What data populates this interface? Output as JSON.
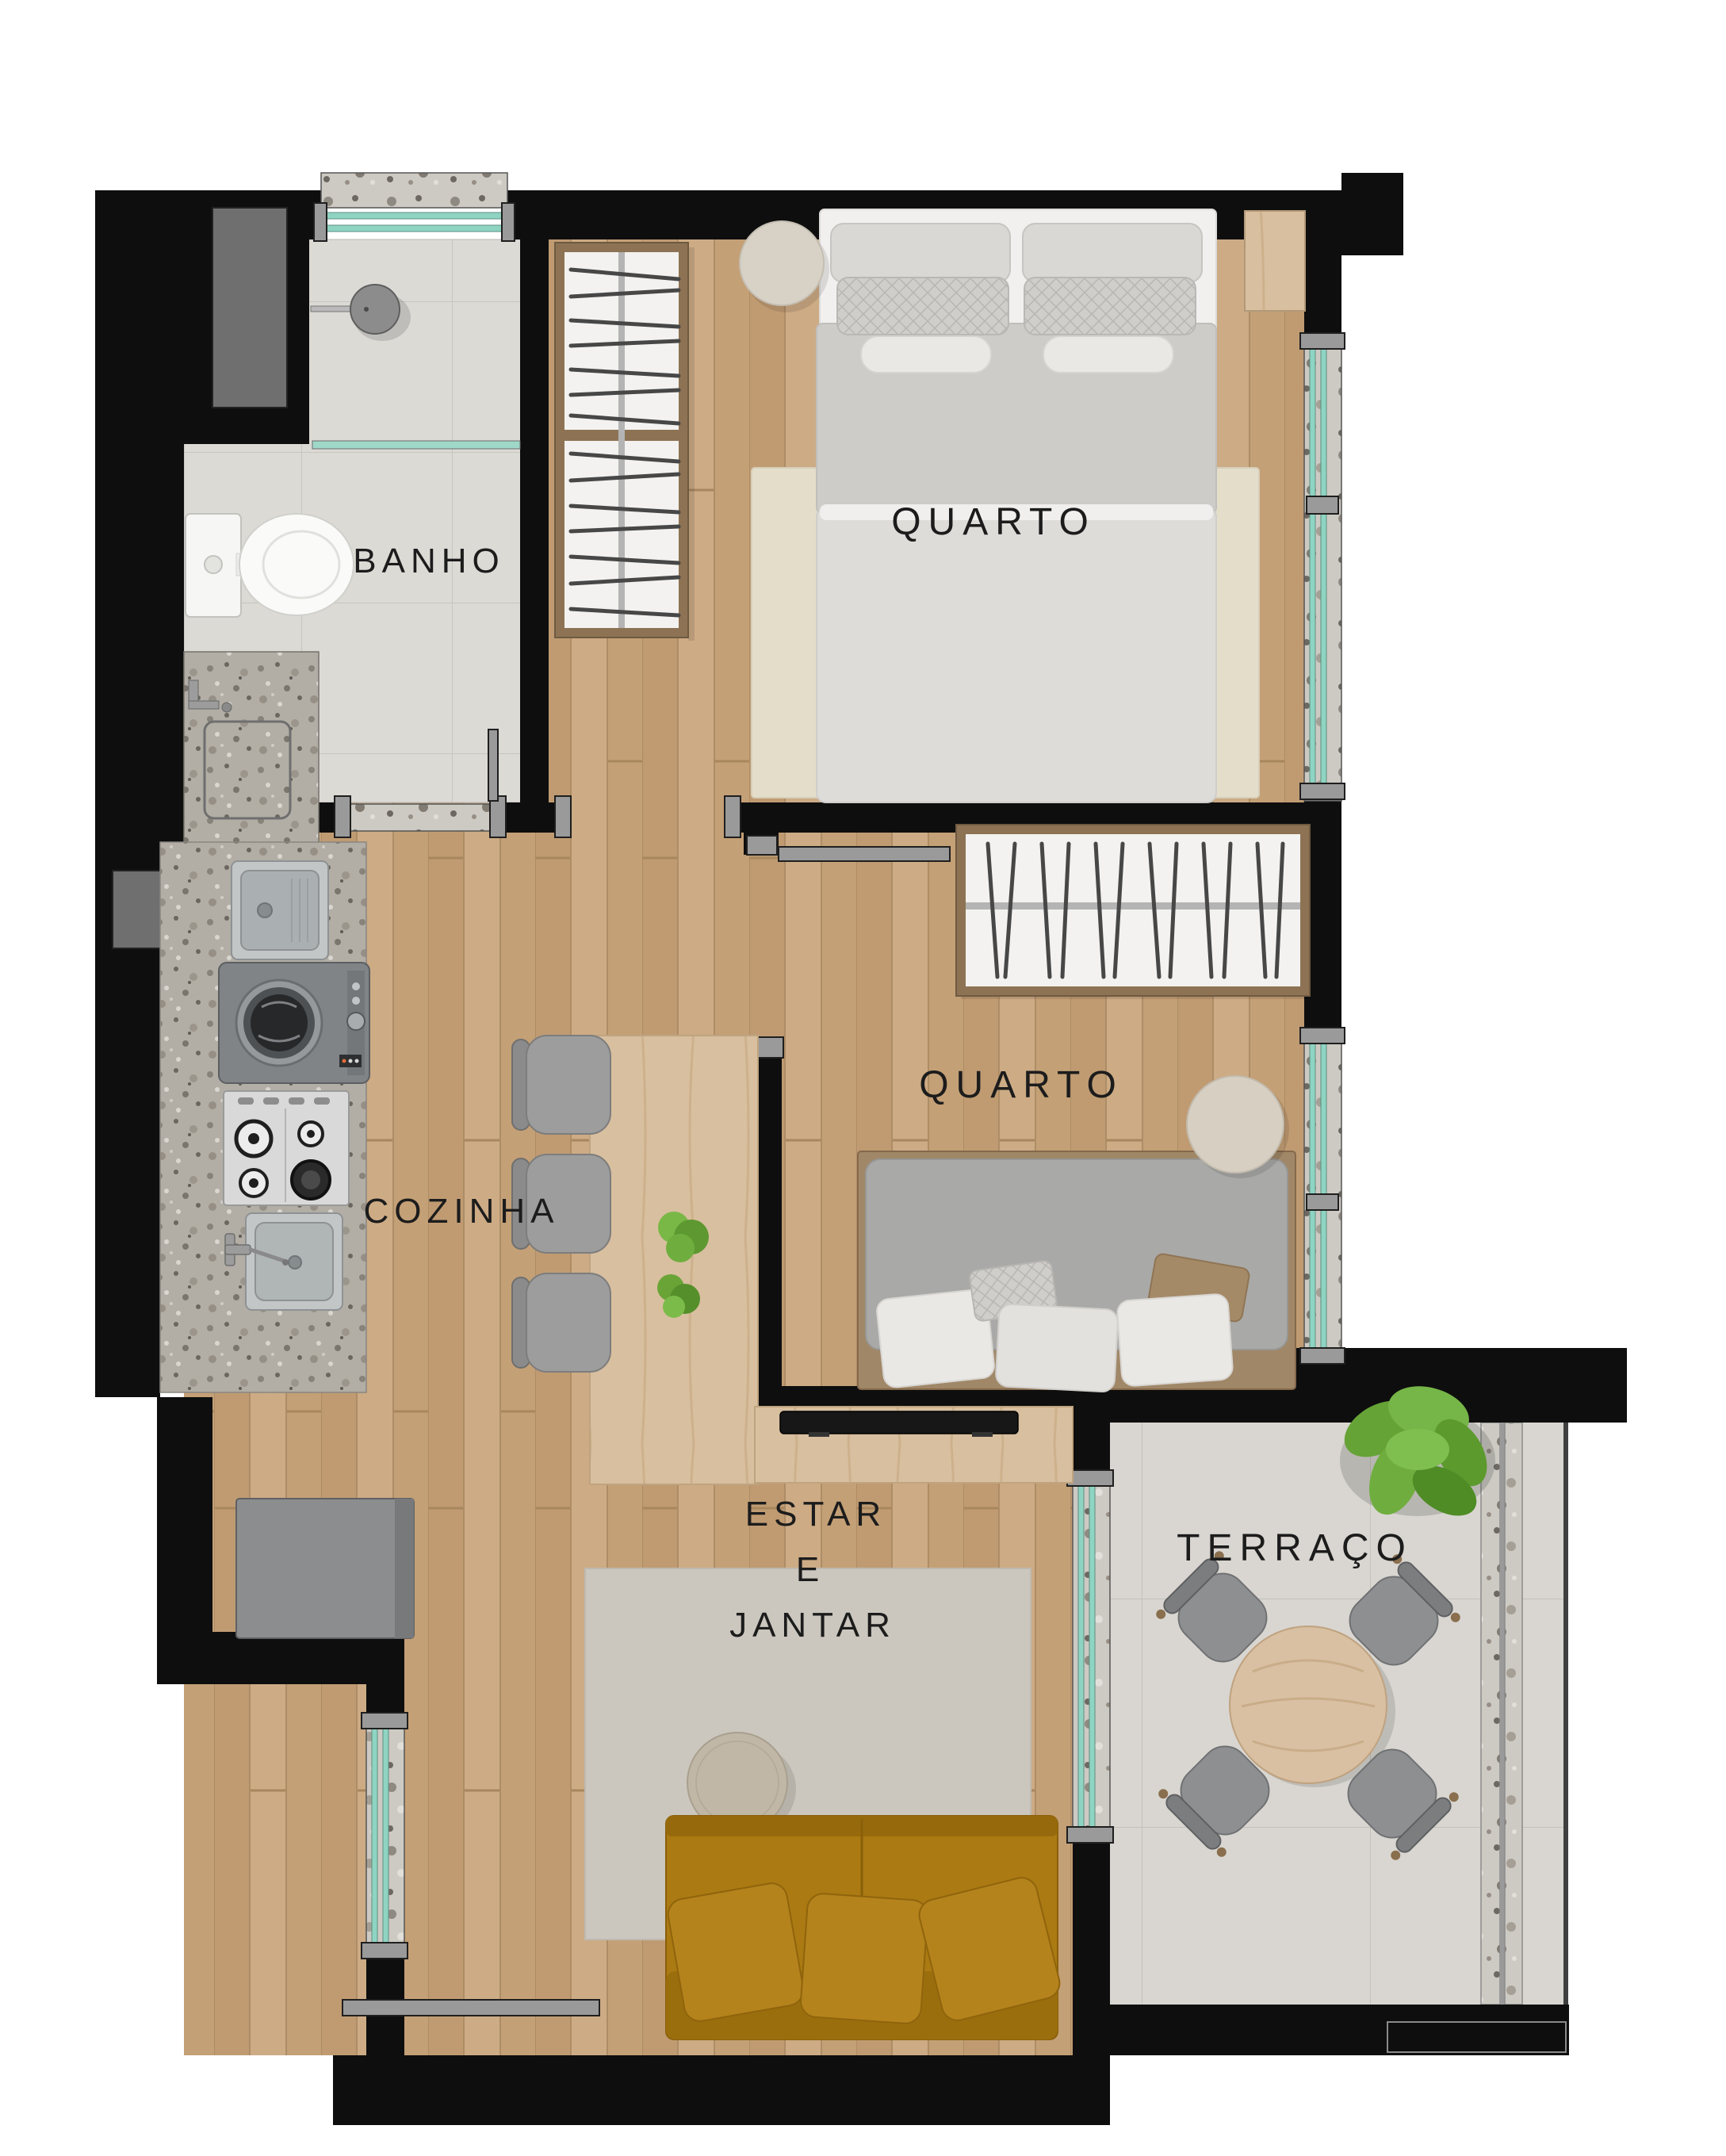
{
  "plan": {
    "rooms": {
      "bathroom": {
        "label": "BANHO"
      },
      "bedroom_main": {
        "label": "QUARTO"
      },
      "bedroom_second": {
        "label": "QUARTO"
      },
      "kitchen": {
        "label": "COZINHA"
      },
      "living_dining": {
        "lines": [
          "ESTAR",
          "E",
          "JANTAR"
        ]
      },
      "terrace": {
        "label": "TERRAÇO"
      }
    },
    "colors": {
      "wall": "#0e0e0e",
      "wood_floor": "#c7a47c",
      "bath_tile": "#dcdad5",
      "terrace_tile": "#d9d6d1",
      "granite": "#b2aea5",
      "window_glass": "#8fd4c2",
      "sofa": "#ab7a12",
      "furniture_gray": "#9b9b9b",
      "wardrobe_frame": "#8d7354",
      "label_text": "#1c1c1c"
    }
  }
}
